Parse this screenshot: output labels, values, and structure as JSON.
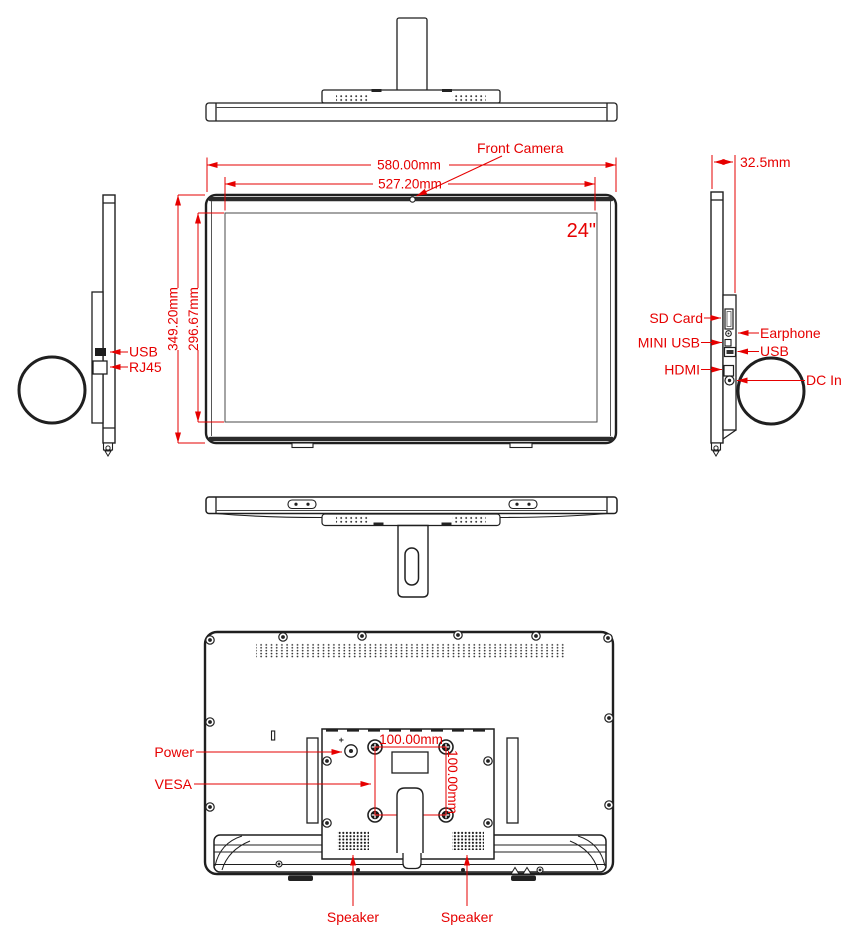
{
  "colors": {
    "line": "#1f1f1f",
    "annotation": "#e60000"
  },
  "front": {
    "camera_label": "Front Camera",
    "size_label": "24\"",
    "outer_width": "580.00mm",
    "screen_width": "527.20mm",
    "outer_height": "349.20mm",
    "screen_height": "296.67mm"
  },
  "left_side": {
    "usb": "USB",
    "rj45": "RJ45"
  },
  "right_side": {
    "thickness": "32.5mm",
    "sd_card": "SD Card",
    "earphone": "Earphone",
    "mini_usb": "MINI USB",
    "usb": "USB",
    "hdmi": "HDMI",
    "dc_in": "DC In"
  },
  "back": {
    "power": "Power",
    "vesa": "VESA",
    "speaker_left": "Speaker",
    "speaker_right": "Speaker",
    "vesa_width": "100.00mm",
    "vesa_height": "100.00mm"
  }
}
